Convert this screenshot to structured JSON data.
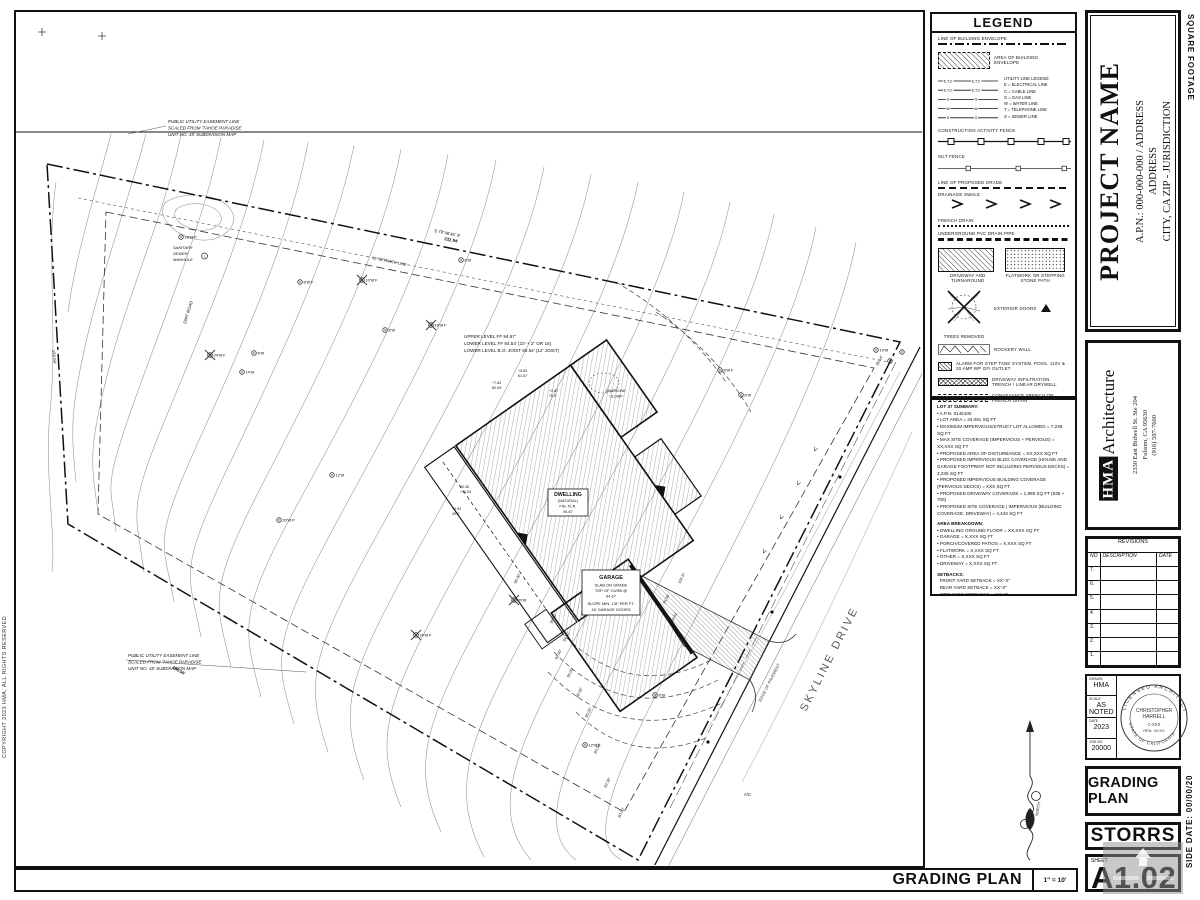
{
  "sheet": {
    "copyright": "COPYRIGHT 2023 HMA, ALL RIGHTS RESERVED",
    "edge_top_right": "SQUARE FOOTAGE",
    "edge_bottom_right": "SIDE DATE:  00/00/20"
  },
  "titleblock": {
    "project_name": "PROJECT NAME",
    "apn_line": "A.P.N.: 000-000-000 / ADDRESS",
    "address_line": "ADDRESS",
    "city_line": "CITY, CA ZIP  -  JURISDICTION",
    "firm": {
      "initials": "HMA",
      "name": "Architecture",
      "address1": "2330 East Bidwell St. Ste 204",
      "address2": "Folsom, CA 95630",
      "phone": "(916) 597-7600"
    },
    "revisions": {
      "title": "REVISIONS",
      "col_no": "NO",
      "col_desc": "DESCRIPTION",
      "col_date": "DATE",
      "rows": [
        "7.",
        "6.",
        "5.",
        "4.",
        "3.",
        "2.",
        "1."
      ]
    },
    "info": {
      "drawn_label": "DRAWN",
      "drawn": "HMA",
      "scale_label": "SCALE",
      "scale": "AS NOTED",
      "date_label": "DATE",
      "date": "2023",
      "job_label": "JOB NO",
      "job": "20000"
    },
    "stamp": {
      "arc_top": "LICENSED ARCHITECT",
      "arc_bottom": "STATE OF CALIFORNIA",
      "name1": "CHRISTOPHER",
      "name2": "HARRELL",
      "lic": "C-XXX",
      "ren": "REN. XX/XX"
    },
    "plan_title": "GRADING PLAN",
    "client": "STORRS",
    "sheet_label": "SHEET",
    "sheet_number": "A1.02"
  },
  "legend": {
    "title": "LEGEND",
    "items": [
      "LINE OF BUILDING ENVELOPE",
      "AREA OF BUILDING ENVELOPE",
      "CONSTRUCTION ACTIVITY FENCE",
      "SILT FENCE",
      "LINE OF PROPOSED GRADE",
      "DRAINAGE SWALE",
      "FRENCH DRAIN",
      "UNDERGROUND PVC DRAIN PIPE",
      "DRIVEWAY AND TURNAROUND",
      "FLATWORK OR STEPPING STONE PATH",
      "EXTERIOR DOORS",
      "TREES REMOVED",
      "ROCKERY WALL",
      "ALARM FOR STEP TANK SYSTEM, POSS. 110V & 20 AMP WP GFI OUTLET",
      "DRIVEWAY INFILTRATION TRENCH / LINEAR DRYWELL",
      "CONVEYANCE TRENCH OR FRENCH DRAIN"
    ],
    "utilities": {
      "header": "UTILITY LINE LEGEND:",
      "lines": [
        "E = ELECTRICAL LINE",
        "C = CABLE LINE",
        "G = GAS LINE",
        "W = WATER LINE",
        "T = TELEPHONE LINE",
        "S = SEWER LINE"
      ],
      "tags": [
        "E,T,C",
        "E,T,C",
        "G",
        "W",
        "S"
      ]
    }
  },
  "summary": {
    "title": "LOT 37 SUMMARY:",
    "items": [
      "A.P.N. 0145100",
      "LOT AREA = 34,081 SQ FT",
      "MAXIMUM IMPERVIOUS/STRUCT LOT ALLOWED = 7,236 SQ FT",
      "MAX SITE COVERAGE (IMPERVIOUS + PERVIOUS) = XX,XXX SQ FT",
      "PROPOSED AREA OF DISTURBANCE = XX,XXX SQ FT",
      "PROPOSED IMPERVIOUS BLDG COVERAGE (HOUSE AND GARAGE FOOTPRINT NOT INCLUDING PERVIOUS DECKS) = 3,236 SQ FT",
      "PROPOSED IMPERVIOUS BUILDING COVERAGE (PERVIOUS DECKS) = XXX SQ FT",
      "PROPOSED DRIVEWAY COVERAGE = 1,995 SQ FT (835 + 705)",
      "PROPOSED SITE COVERAGE | IMPERVIOUS (BUILDING COVERAGE, DRIVEWAY) = 4,443 SQ FT"
    ],
    "area_title": "AREA BREAKDOWN:",
    "area_items": [
      "DWELLING GROUND FLOOR = XX,XXX SQ FT",
      "GARAGE = X,XXX SQ FT",
      "PORCH/COVERED PATIOS = X,XXX SQ FT",
      "FLATWORK = X,XXX SQ FT",
      "OTHER = X,XXX SQ FT",
      "DRIVEWAY = X,XXX SQ FT"
    ],
    "setbacks_title": "SETBACKS:",
    "setback_items": [
      "FRONT YARD SETBACK = XX'-X\"",
      "REAR YARD SETBACK = XX'-X\"",
      "SIDE YARD SETBACKS = XX'-X\""
    ]
  },
  "plan": {
    "title": "GRADING PLAN",
    "scale": "1\" = 10'",
    "north_label": "NORTH",
    "labels": [
      {
        "x": 152,
        "y": 111,
        "t": "PUBLIC UTILITY EASEMENT LINE",
        "i": 1
      },
      {
        "x": 152,
        "y": 117.5,
        "t": "SCALED FROM 'TAHOE PARADISE",
        "i": 1
      },
      {
        "x": 152,
        "y": 124,
        "t": "UNIT NO. 45' SUBDIVISION MAP",
        "i": 1
      },
      {
        "x": 112,
        "y": 645,
        "t": "PUBLIC UTILITY EASEMENT LINE",
        "i": 1
      },
      {
        "x": 112,
        "y": 651.5,
        "t": "SCALED FROM 'TAHOE PARADISE",
        "i": 1
      },
      {
        "x": 112,
        "y": 658,
        "t": "UNIT NO. 45' SUBDIVISION MAP",
        "i": 1
      },
      {
        "x": 418,
        "y": 220,
        "t": "S 79°48'45\" E",
        "r": 11.5,
        "s": 4.3
      },
      {
        "x": 428,
        "y": 228,
        "t": "232.94'",
        "r": 11.5,
        "s": 4.3,
        "b": 1
      },
      {
        "x": 356,
        "y": 247,
        "t": "15' SETBACK LINE",
        "r": 11.5,
        "s": 4
      },
      {
        "x": 36,
        "y": 338,
        "t": "150.04'",
        "r": 84,
        "s": 4.3
      },
      {
        "x": 156,
        "y": 656,
        "t": "185.56'",
        "r": 31,
        "s": 4.3,
        "b": 1
      },
      {
        "x": 862,
        "y": 354,
        "t": "35.14'",
        "r": -63,
        "s": 4
      },
      {
        "x": 157,
        "y": 237,
        "t": "SANITARY",
        "i": 1,
        "s": 4
      },
      {
        "x": 157,
        "y": 243,
        "t": "SEWER",
        "i": 1,
        "s": 4
      },
      {
        "x": 157,
        "y": 249,
        "t": "MANHOLE",
        "i": 1,
        "s": 4
      },
      {
        "x": 188.5,
        "y": 245.6,
        "t": "S",
        "s": 3,
        "a": "m"
      },
      {
        "x": 170,
        "y": 312,
        "t": "DIRT ROAD",
        "r": -73,
        "s": 4.3,
        "i": 1
      },
      {
        "x": 448,
        "y": 326,
        "t": "UPPER LEVEL FF 94.67'",
        "s": 4.6
      },
      {
        "x": 448,
        "y": 333,
        "t": "LOWER LEVEL FF 84.54' (10' + 2\" OR 16)",
        "s": 4.6
      },
      {
        "x": 448,
        "y": 340,
        "t": "LOWER LEVEL B.O. JOIST 93.54' (12' JOIST)",
        "s": 4.6
      },
      {
        "x": 600,
        "y": 380,
        "t": "MADRONE",
        "s": 3.8,
        "a": "m",
        "i": 1
      },
      {
        "x": 600,
        "y": 385.5,
        "t": "CLUMP",
        "s": 3.8,
        "a": "m",
        "i": 1
      },
      {
        "x": 552,
        "y": 484,
        "t": "DWELLING",
        "s": 5.2,
        "b": 1,
        "a": "m"
      },
      {
        "x": 552,
        "y": 490,
        "t": "(NATURAL)",
        "s": 3.8,
        "a": "m"
      },
      {
        "x": 552,
        "y": 495.5,
        "t": "FIN. FL'R.",
        "s": 3.8,
        "a": "m"
      },
      {
        "x": 552,
        "y": 501,
        "t": "94.67",
        "s": 3.8,
        "a": "m"
      },
      {
        "x": 595,
        "y": 567,
        "t": "GARAGE",
        "s": 5.4,
        "b": 1,
        "a": "m"
      },
      {
        "x": 595,
        "y": 574.5,
        "t": "SLAB ON GRADE",
        "s": 4,
        "a": "m"
      },
      {
        "x": 595,
        "y": 580,
        "t": "TOP OF CURB @",
        "s": 4,
        "a": "m"
      },
      {
        "x": 595,
        "y": 585.5,
        "t": "94.67",
        "s": 4,
        "a": "m"
      },
      {
        "x": 595,
        "y": 593,
        "t": "SLOPE MIN. 1/8\" PER FT.",
        "s": 4,
        "a": "m"
      },
      {
        "x": 595,
        "y": 599,
        "t": "16' GARAGE DOORS",
        "s": 4,
        "a": "m"
      },
      {
        "x": 790,
        "y": 700,
        "t": "SKYLINE DRIVE",
        "r": -63,
        "s": 11,
        "f": "#555",
        "ls": 2.5
      },
      {
        "x": 745,
        "y": 690,
        "t": "EDGE OF PAVEMENT",
        "r": -63,
        "s": 4.2,
        "f": "#444"
      },
      {
        "x": 728,
        "y": 784,
        "t": "A/C",
        "s": 4.2
      },
      {
        "x": 500,
        "y": 572,
        "t": "98.00'",
        "r": -63,
        "s": 4,
        "f": "#333"
      },
      {
        "x": 536,
        "y": 612,
        "t": "96.00'",
        "r": -63,
        "s": 4,
        "f": "#333"
      },
      {
        "x": 549,
        "y": 630,
        "t": "94.00'",
        "r": -63,
        "s": 4,
        "f": "#333"
      },
      {
        "x": 541,
        "y": 648,
        "t": "92.00'",
        "r": -63,
        "s": 4,
        "f": "#333"
      },
      {
        "x": 553,
        "y": 666,
        "t": "90.00'",
        "r": -63,
        "s": 4,
        "f": "#333"
      },
      {
        "x": 562,
        "y": 686,
        "t": "88.00'",
        "r": -63,
        "s": 4,
        "f": "#333"
      },
      {
        "x": 571,
        "y": 706,
        "t": "86.00'",
        "r": -63,
        "s": 4,
        "f": "#333"
      },
      {
        "x": 580,
        "y": 742,
        "t": "84.00'",
        "r": -63,
        "s": 4,
        "f": "#333"
      },
      {
        "x": 590,
        "y": 776,
        "t": "82.00'",
        "r": -63,
        "s": 4,
        "f": "#333"
      },
      {
        "x": 604,
        "y": 806,
        "t": "80.00'",
        "r": -63,
        "s": 4,
        "f": "#333"
      },
      {
        "x": 664,
        "y": 572,
        "t": "104.37",
        "r": -63,
        "s": 3.8
      },
      {
        "x": 649,
        "y": 592,
        "t": "94.58",
        "r": -63,
        "s": 3.8
      },
      {
        "x": 657,
        "y": 610,
        "t": "94.62",
        "r": -63,
        "s": 3.8
      },
      {
        "x": 476,
        "y": 372,
        "t": "+7.84",
        "s": 3.6
      },
      {
        "x": 476,
        "y": 377,
        "t": "60.54'",
        "s": 3.6
      },
      {
        "x": 502,
        "y": 360,
        "t": "+5.83",
        "s": 3.6
      },
      {
        "x": 502,
        "y": 365,
        "t": "61.67'",
        "s": 3.6
      },
      {
        "x": 533,
        "y": 380,
        "t": "+2.87",
        "s": 3.6
      },
      {
        "x": 533,
        "y": 385,
        "t": "70.9'",
        "s": 3.6
      },
      {
        "x": 444,
        "y": 476,
        "t": "60.36",
        "s": 3.6
      },
      {
        "x": 444,
        "y": 481,
        "t": "+10.04",
        "s": 3.6
      },
      {
        "x": 436,
        "y": 498,
        "t": "+0.93",
        "s": 3.6
      },
      {
        "x": 436,
        "y": 503,
        "t": "49.9'",
        "s": 3.6
      },
      {
        "x": 798,
        "y": 434,
        "t": ">",
        "r": 117,
        "s": 8,
        "f": "#333"
      },
      {
        "x": 781,
        "y": 468,
        "t": ">",
        "r": 117,
        "s": 8,
        "f": "#333"
      },
      {
        "x": 764,
        "y": 502,
        "t": ">",
        "r": 117,
        "s": 8,
        "f": "#333"
      },
      {
        "x": 747,
        "y": 536,
        "t": ">",
        "r": 117,
        "s": 8,
        "f": "#333"
      }
    ],
    "trees": [
      {
        "x": 165,
        "y": 225,
        "t": "18\"Ø P"
      },
      {
        "x": 194,
        "y": 343,
        "t": "24\"Ø F",
        "rm": 1
      },
      {
        "x": 226,
        "y": 360,
        "t": "14\"Ø"
      },
      {
        "x": 238,
        "y": 341,
        "t": "6\"Ø"
      },
      {
        "x": 284,
        "y": 270,
        "t": "8\"Ø F"
      },
      {
        "x": 346,
        "y": 268,
        "t": "10\"Ø F",
        "rm": 1
      },
      {
        "x": 369,
        "y": 318,
        "t": "8\"Ø"
      },
      {
        "x": 415,
        "y": 313,
        "t": "18\"Ø F",
        "rm": 1
      },
      {
        "x": 445,
        "y": 248,
        "t": "8\"Ø"
      },
      {
        "x": 263,
        "y": 508,
        "t": "20\"Ø P"
      },
      {
        "x": 316,
        "y": 463,
        "t": "12\"Ø"
      },
      {
        "x": 400,
        "y": 623,
        "t": "24\"Ø F",
        "rm": 1
      },
      {
        "x": 498,
        "y": 588,
        "t": "20\"Ø",
        "rm": 1
      },
      {
        "x": 569,
        "y": 733,
        "t": "12\"Ø F"
      },
      {
        "x": 639,
        "y": 683,
        "t": "8\"Ø"
      },
      {
        "x": 704,
        "y": 358,
        "t": "8\"Ø F"
      },
      {
        "x": 725,
        "y": 383,
        "t": "6\"Ø"
      },
      {
        "x": 860,
        "y": 338,
        "t": "14\"Ø"
      },
      {
        "x": 874,
        "y": 349,
        "t": ""
      },
      {
        "x": 886,
        "y": 340,
        "t": ""
      }
    ]
  }
}
